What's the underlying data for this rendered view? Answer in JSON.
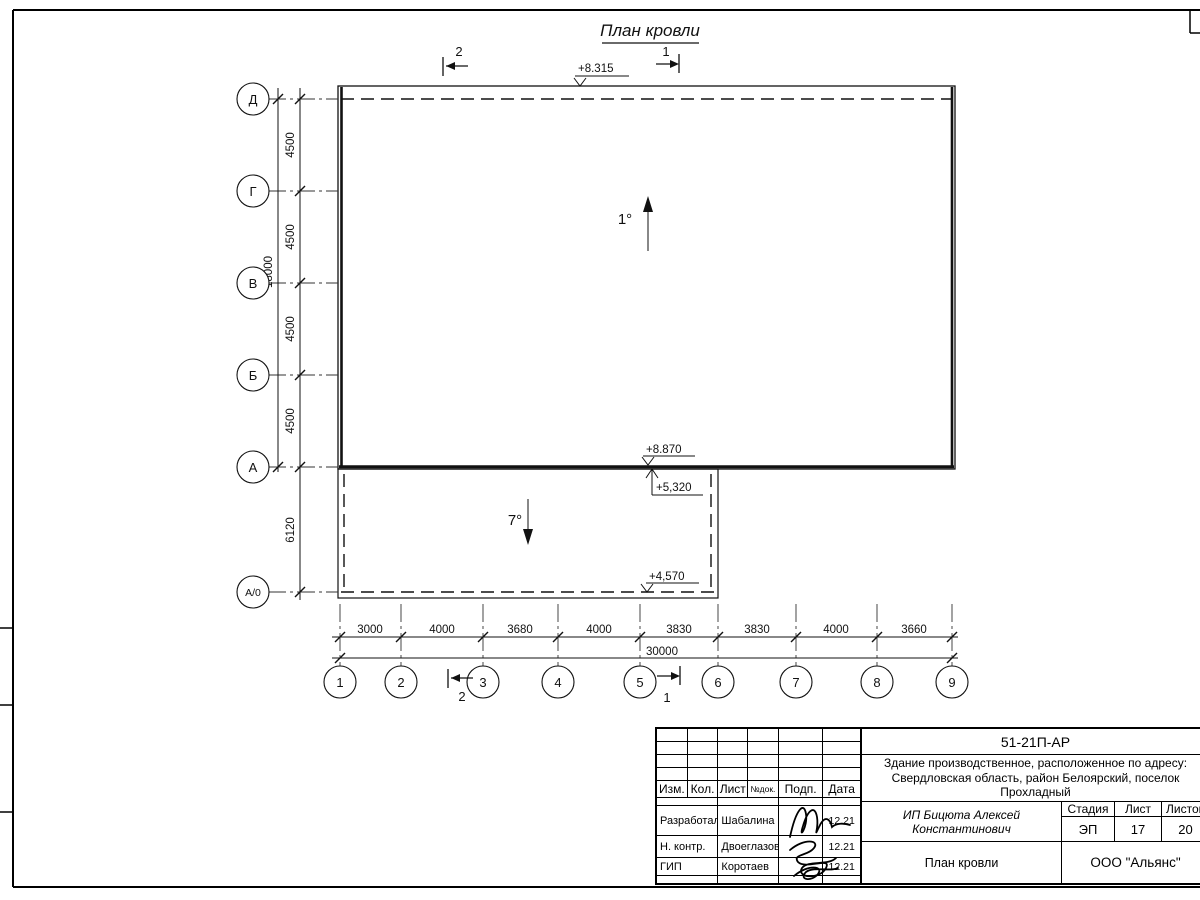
{
  "drawing": {
    "title": "План кровли",
    "slope_main": "1°",
    "slope_annex": "7°",
    "elev_top": "+8.315",
    "elev_main_edge": "+8.870",
    "elev_annex_top": "+5,320",
    "elev_annex_edge": "+4,570",
    "section_cut_1": "1",
    "section_cut_2": "2"
  },
  "axes": {
    "left": [
      "Д",
      "Г",
      "В",
      "Б",
      "А",
      "А/0"
    ],
    "bottom": [
      "1",
      "2",
      "3",
      "4",
      "5",
      "6",
      "7",
      "8",
      "9"
    ]
  },
  "dims": {
    "left_spans": [
      "4500",
      "4500",
      "4500",
      "4500"
    ],
    "left_total": "18000",
    "left_annex": "6120",
    "bottom_spans": [
      "3000",
      "4000",
      "3680",
      "4000",
      "3830",
      "3830",
      "4000",
      "3660"
    ],
    "bottom_total": "30000"
  },
  "titleblock": {
    "doc_number": "51-21П-АР",
    "project_name_line1": "Здание производственное, расположенное по адресу:",
    "project_name_line2": "Свердловская область, район Белоярский, поселок",
    "project_name_line3": "Прохладный",
    "client": "ИП Бицюта Алексей Константинович",
    "sheet_title": "План кровли",
    "company": "ООО \"Альянс\"",
    "stage_label": "Стадия",
    "stage_value": "ЭП",
    "sheet_label": "Лист",
    "sheet_value": "17",
    "sheets_label": "Листов",
    "sheets_value": "20",
    "cols": [
      "Изм.",
      "Кол.",
      "Лист",
      "№док.",
      "Подп.",
      "Дата"
    ],
    "rows": [
      {
        "role": "Разработал",
        "name": "Шабалина",
        "date": "12.21"
      },
      {
        "role": "Н. контр.",
        "name": "Двоеглазов",
        "date": "12.21"
      },
      {
        "role": "ГИП",
        "name": "Коротаев",
        "date": "12.21"
      }
    ]
  }
}
